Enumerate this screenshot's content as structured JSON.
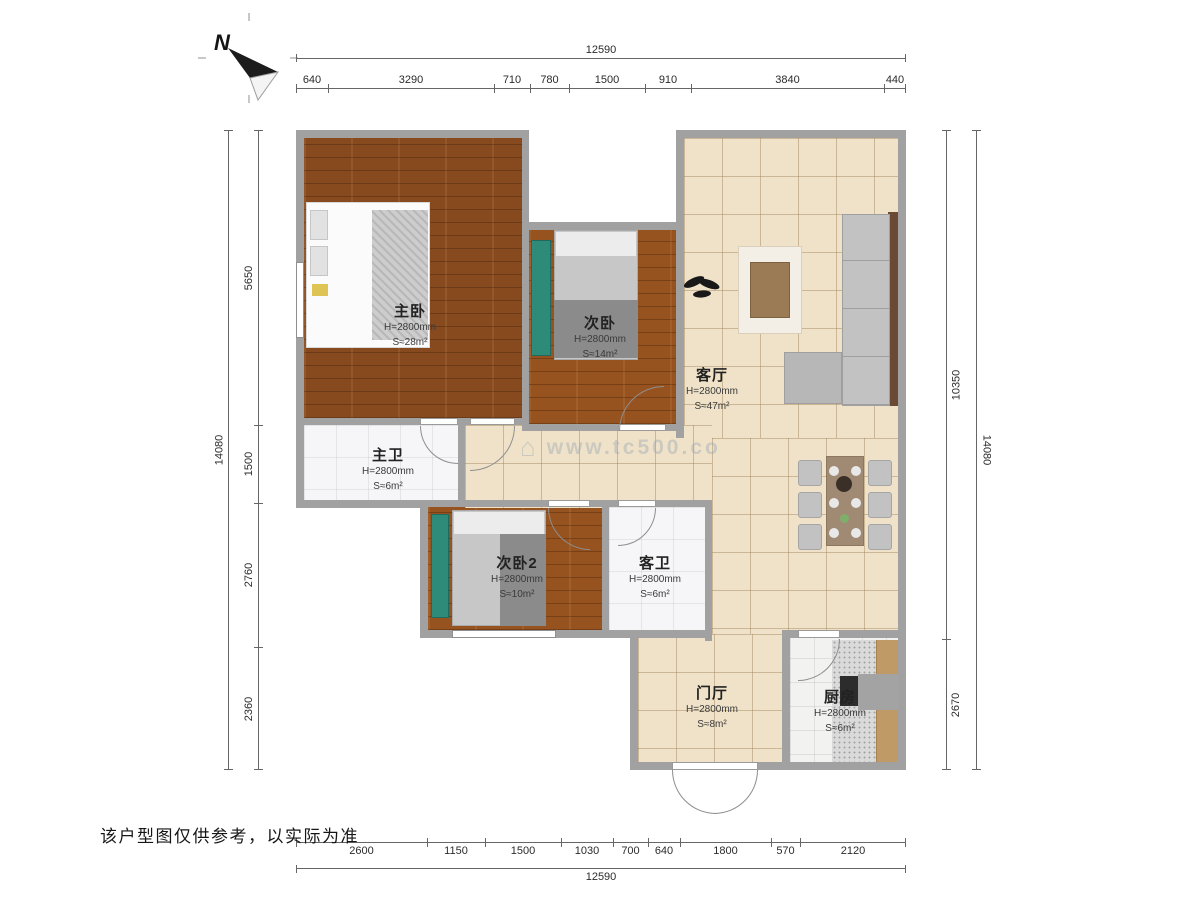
{
  "page": {
    "disclaimer": "该户型图仅供参考，以实际为准"
  },
  "north": {
    "label": "N"
  },
  "watermark": {
    "text": "www.tc500.co"
  },
  "dimensions": {
    "top": {
      "total": "12590",
      "segments": [
        "640",
        "3290",
        "710",
        "780",
        "1500",
        "910",
        "3840",
        "440"
      ]
    },
    "bottom": {
      "total": "12590",
      "segments": [
        "2600",
        "1150",
        "1500",
        "1030",
        "700",
        "640",
        "1800",
        "570",
        "2120"
      ]
    },
    "left": {
      "total": "14080",
      "segments": [
        "5650",
        "1500",
        "2760",
        "2360"
      ]
    },
    "right": {
      "total": "14080",
      "segments": [
        "10350",
        "2670"
      ]
    }
  },
  "rooms": [
    {
      "name": "主卧",
      "height": "H=2800mm",
      "area": "S≈28m²"
    },
    {
      "name": "次卧",
      "height": "H=2800mm",
      "area": "S≈14m²"
    },
    {
      "name": "客厅",
      "height": "H=2800mm",
      "area": "S≈47m²"
    },
    {
      "name": "主卫",
      "height": "H=2800mm",
      "area": "S≈6m²"
    },
    {
      "name": "次卧2",
      "height": "H=2800mm",
      "area": "S≈10m²"
    },
    {
      "name": "客卫",
      "height": "H=2800mm",
      "area": "S≈6m²"
    },
    {
      "name": "门厅",
      "height": "H=2800mm",
      "area": "S≈8m²"
    },
    {
      "name": "厨房",
      "height": "H=2800mm",
      "area": "S≈6m²"
    }
  ],
  "colors": {
    "wall": "#a1a1a1",
    "wood_floor": "#96521f",
    "tile_floor": "#efe2c8",
    "marble_floor": "#f6f6f8",
    "kitchen_floor": "#f2f2f1",
    "wardrobe_teal": "#2e8b7a",
    "sofa_frame_brown": "#6b4a35",
    "dimension_text": "#2b2b2b"
  }
}
